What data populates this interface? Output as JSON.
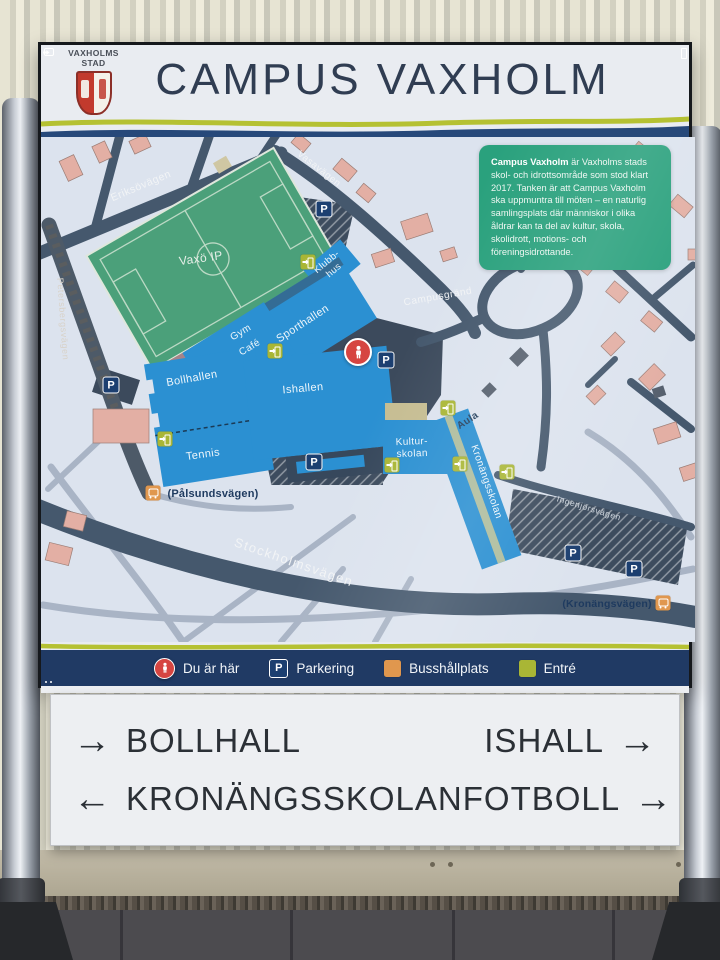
{
  "header": {
    "logo_line1": "VAXHOLMS",
    "logo_line2": "STAD",
    "title": "CAMPUS VAXHOLM"
  },
  "info_box": {
    "lead": "Campus Vaxholm",
    "text": " är Vaxholms stads skol- och idrottsområde som stod klart 2017. Tanken är att Campus Vaxholm ska uppmuntra till möten – en naturlig samlingsplats där människor i olika åldrar kan ta del av kultur, skola, skolidrott, motions- och föreningsidrottande."
  },
  "map": {
    "streets": {
      "eriksovagen": "Eriksövägen",
      "vasavagen": "Vasavägen",
      "petersbergsvagen": "Petersbergsvägen",
      "campusgrand": "Campusgränd",
      "palsundsvagen": "(Pålsundsvägen)",
      "stockholmsvagen": "Stockholmsvägen",
      "ingenjorsvagen": "Ingenjörsvägen",
      "kronangsvagen": "(Kronängsvägen)"
    },
    "places": {
      "field": "Vaxö IP",
      "klubbhus_line1": "Klubb-",
      "klubbhus_line2": "hus",
      "sporthallen": "Sporthallen",
      "gym": "Gym",
      "cafe": "Café",
      "bollhallen": "Bollhallen",
      "tennis": "Tennis",
      "ishallen": "Ishallen",
      "kulturskolan_line1": "Kultur-",
      "kulturskolan_line2": "skolan",
      "aula": "Aula",
      "kronangsskolan": "Kronängsskolan"
    },
    "icons": {
      "parking_letter": "P"
    }
  },
  "legend": {
    "items": [
      {
        "icon": "you-are-here",
        "label": "Du är här"
      },
      {
        "icon": "parking",
        "label": "Parkering"
      },
      {
        "icon": "bus",
        "label": "Busshållplats"
      },
      {
        "icon": "entrance",
        "label": "Entré"
      }
    ]
  },
  "directions": {
    "rows": [
      {
        "left": {
          "arrow": "→",
          "label": "BOLLHALL"
        },
        "right": {
          "label": "ISHALL",
          "arrow": "→"
        }
      },
      {
        "left": {
          "arrow": "←",
          "label": "KRONÄNGSSKOLAN"
        },
        "right": {
          "label": "FOTBOLL",
          "arrow": "→"
        }
      }
    ]
  },
  "colors": {
    "accent_lime": "#b5c132",
    "navy_stripe": "#27497a",
    "legend_bg": "#203a64",
    "building_blue": "#2b90d2",
    "field_green": "#4ba07a",
    "info_green": "#2aa17d",
    "you_are_here_red": "#d64541",
    "bus_orange": "#e0974e",
    "entrance_green": "#a9b635",
    "parking_navy": "#1c3f70"
  }
}
